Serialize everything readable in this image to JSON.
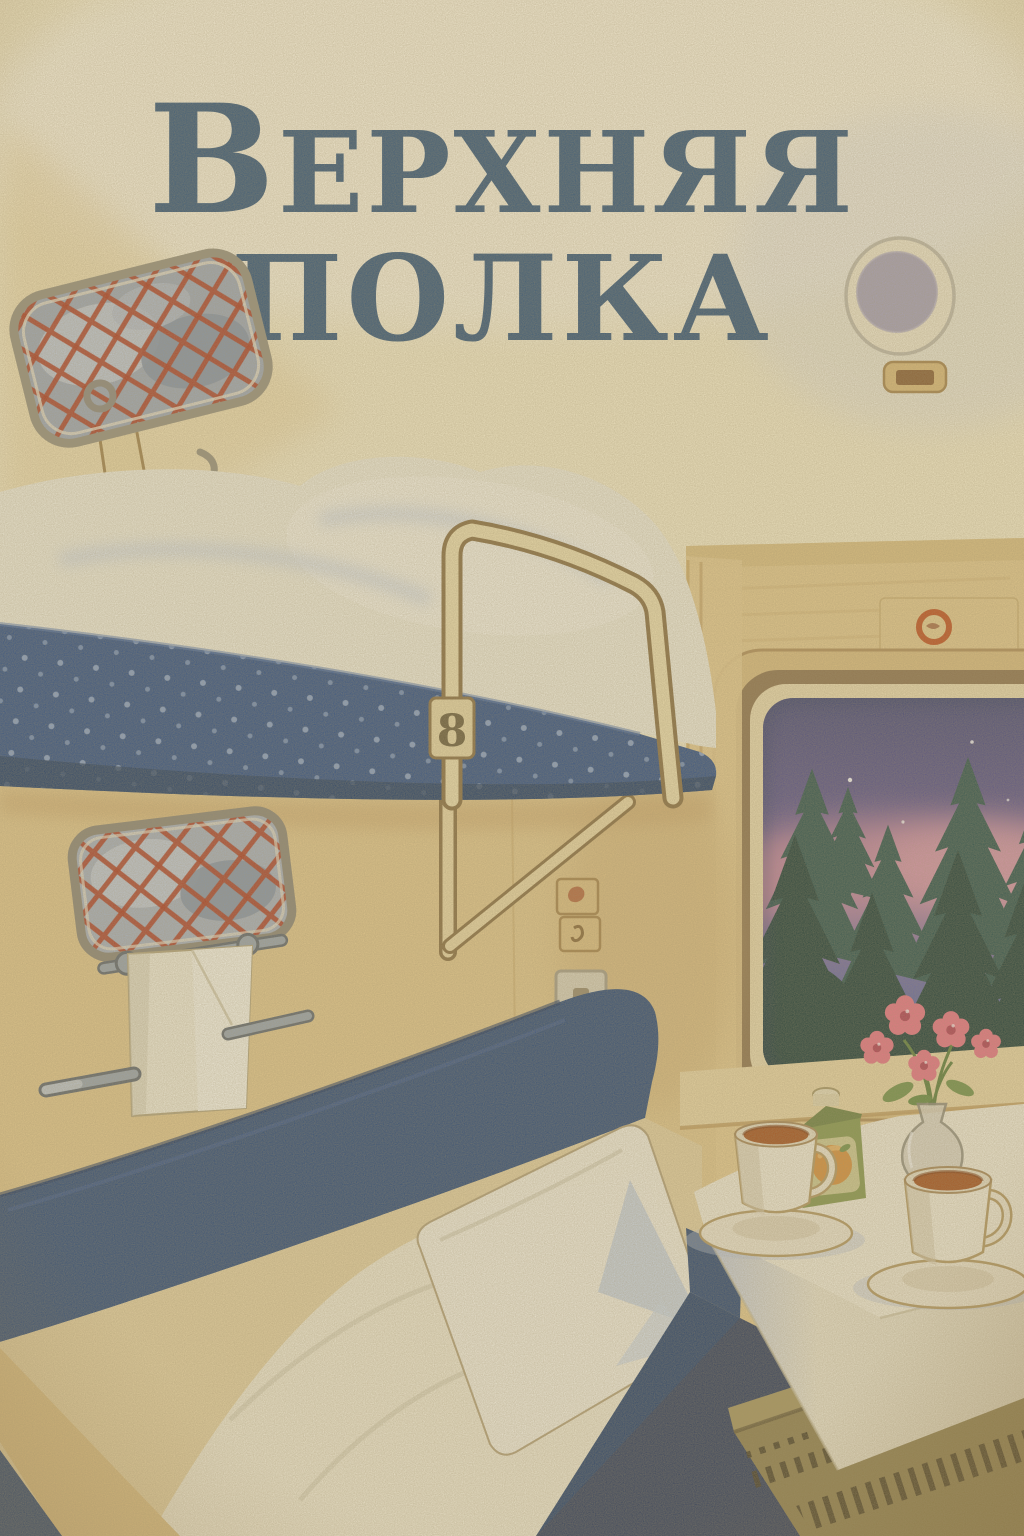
{
  "poster": {
    "title": {
      "line1_initial": "В",
      "line1_rest": "ЕРХНЯЯ",
      "line2": "ПОЛКА",
      "color": "#33567a"
    },
    "berth_number": "8",
    "palette": {
      "paper": "#f6ecca",
      "ceiling": "#f8f1dc",
      "wall_tan": "#e4c98e",
      "wall_right": "#e6cb8f",
      "mattress_blue": "#2e4f86",
      "mattress_dot": "#9db4d8",
      "backrest_navy": "#2c4a78",
      "bedding_white": "#f2eedd",
      "rail_cream": "#efe0b0",
      "net_red": "#b03c22",
      "metal_grey": "#9aa5b0",
      "window_frame_brown": "#8f744e",
      "window_frame_cream": "#ecdcb0",
      "sky_purple": "#454879",
      "sky_pink": "#cd8aa4",
      "tree_back": "#2d524e",
      "tree_front": "#1e3d39",
      "emblem_red": "#c2511f",
      "tablecloth": "#f3edda",
      "tea_brown": "#a5521e",
      "carton_green": "#87994e",
      "flower_pink": "#ea7486",
      "radiator_olive": "#90804e",
      "speaker_lavender": "#a8a2b8",
      "towel_white": "#f2edda"
    },
    "objects": [
      "luggage-net-rack",
      "ceiling-speaker",
      "upper-berth",
      "berth-guard-rail",
      "berth-number-tag",
      "towel-net-rack",
      "towel",
      "grab-handles",
      "wall-switches",
      "compartment-window",
      "night-forest-view",
      "round-emblem",
      "window-sill",
      "flower-vase",
      "juice-carton",
      "tea-cups",
      "folding-table",
      "tablecloth",
      "radiator",
      "lower-berth",
      "pillow",
      "backrest"
    ]
  }
}
